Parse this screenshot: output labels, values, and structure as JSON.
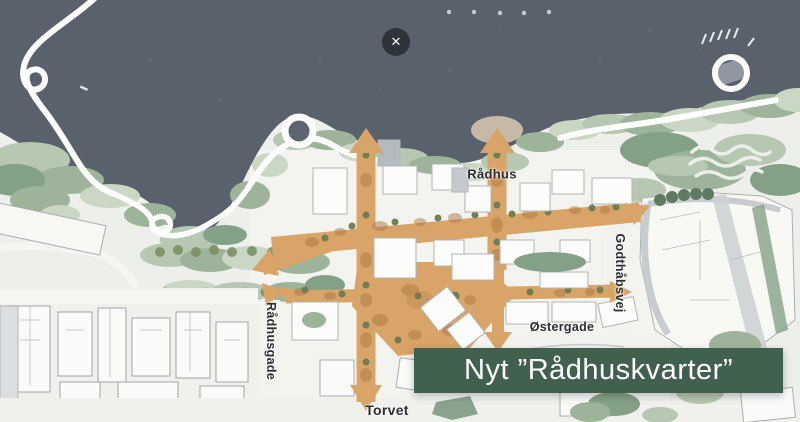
{
  "window": {
    "width": 800,
    "height": 422
  },
  "overlay": {
    "close_icon_glyph": "✕"
  },
  "banner": {
    "text": "Nyt ”Rådhuskvarter”",
    "background": "#41604e",
    "text_color": "#ffffff"
  },
  "map": {
    "type": "urban-masterplan-site-plan",
    "labels": {
      "radhus": "Rådhus",
      "godthabsvej": "Godthåbsvej",
      "ostergade": "Østergade",
      "radhusgade": "Rådhusgade",
      "torvet": "Torvet"
    },
    "colors": {
      "water": "#59616c",
      "land": "#eef0ec",
      "vegetation": "#a3b8a1",
      "street_orange": "#d8a468",
      "building_fill": "#fcfcfa",
      "building_stroke": "#b3b6b3",
      "label_text": "#2b2f33"
    }
  }
}
